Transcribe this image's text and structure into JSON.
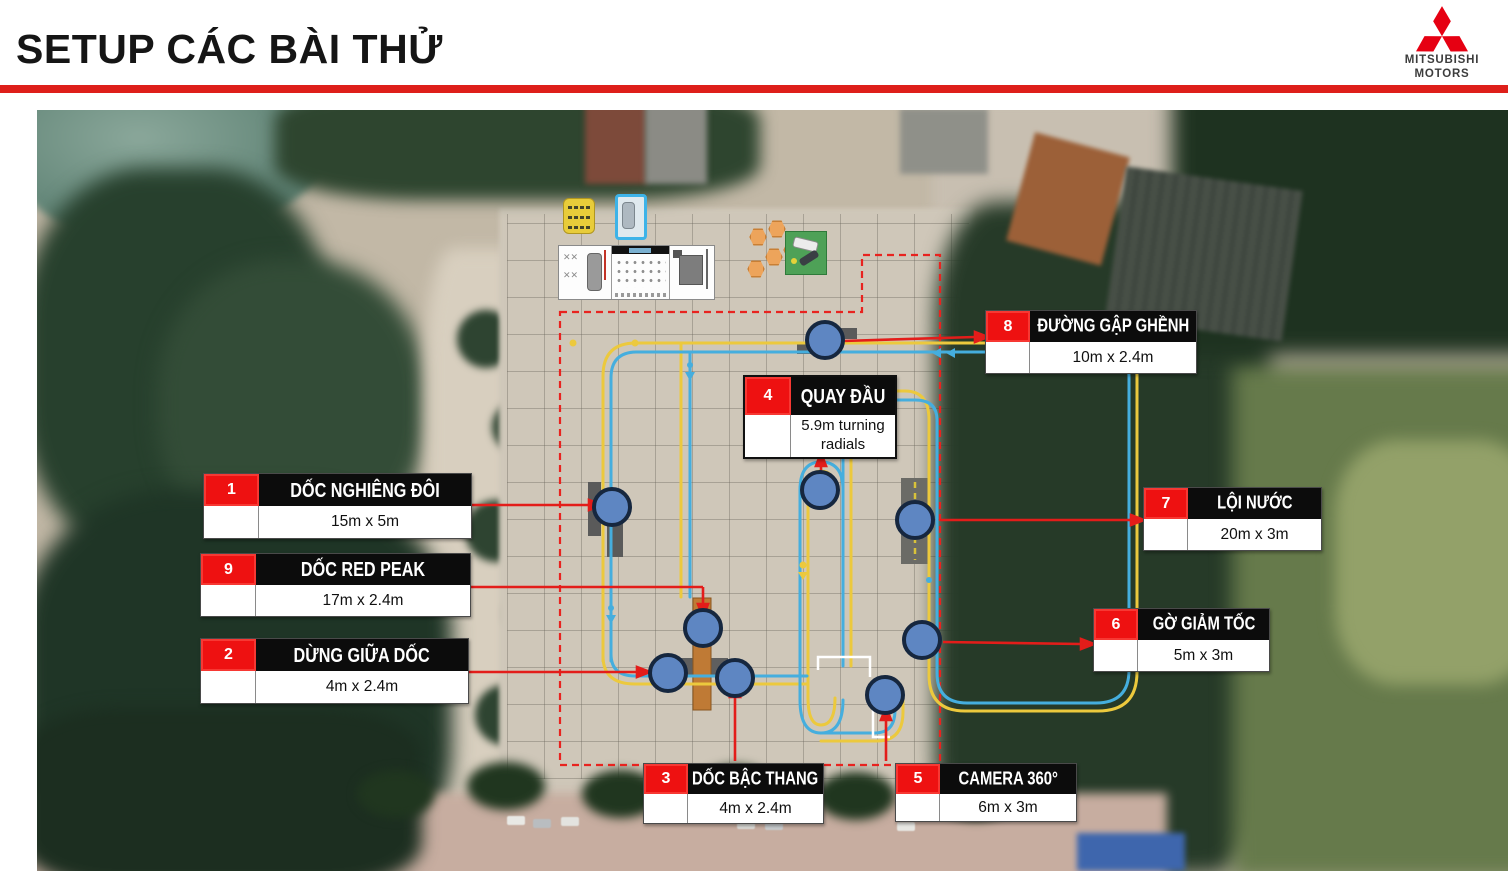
{
  "header": {
    "title": "SETUP CÁC BÀI THỬ",
    "logo": {
      "line1": "MITSUBISHI",
      "line2": "MOTORS"
    }
  },
  "colors": {
    "rule_red": "#de1f1a",
    "callout_number_red": "#ee1111",
    "callout_title_bg": "#0c0c0c",
    "brand_red": "#e60012",
    "track_blue": "#45aede",
    "track_yellow": "#ecc93d",
    "boundary_red": "#e8231f",
    "station_circle": "#5e86c2"
  },
  "callouts": [
    {
      "num": "1",
      "title": "DỐC NGHIÊNG ĐÔI",
      "dims": "15m x 5m"
    },
    {
      "num": "9",
      "title": "DỐC RED PEAK",
      "dims": "17m x 2.4m"
    },
    {
      "num": "2",
      "title": "DỪNG GIỮA DỐC",
      "dims": "4m x 2.4m"
    },
    {
      "num": "3",
      "title": "DỐC BẬC THANG",
      "dims": "4m x 2.4m"
    },
    {
      "num": "4",
      "title": "QUAY ĐẦU",
      "dims": "5.9m turning radials",
      "dims_line1": "5.9m turning",
      "dims_line2": "radials"
    },
    {
      "num": "5",
      "title": "CAMERA 360°",
      "dims": "6m x 3m"
    },
    {
      "num": "6",
      "title": "GỜ GIẢM TỐC",
      "dims": "5m x 3m"
    },
    {
      "num": "7",
      "title": "LỘI NƯỚC",
      "dims": "20m x 3m"
    },
    {
      "num": "8",
      "title": "ĐƯỜNG GẬP GHỀNH",
      "dims": "10m x 2.4m"
    }
  ]
}
